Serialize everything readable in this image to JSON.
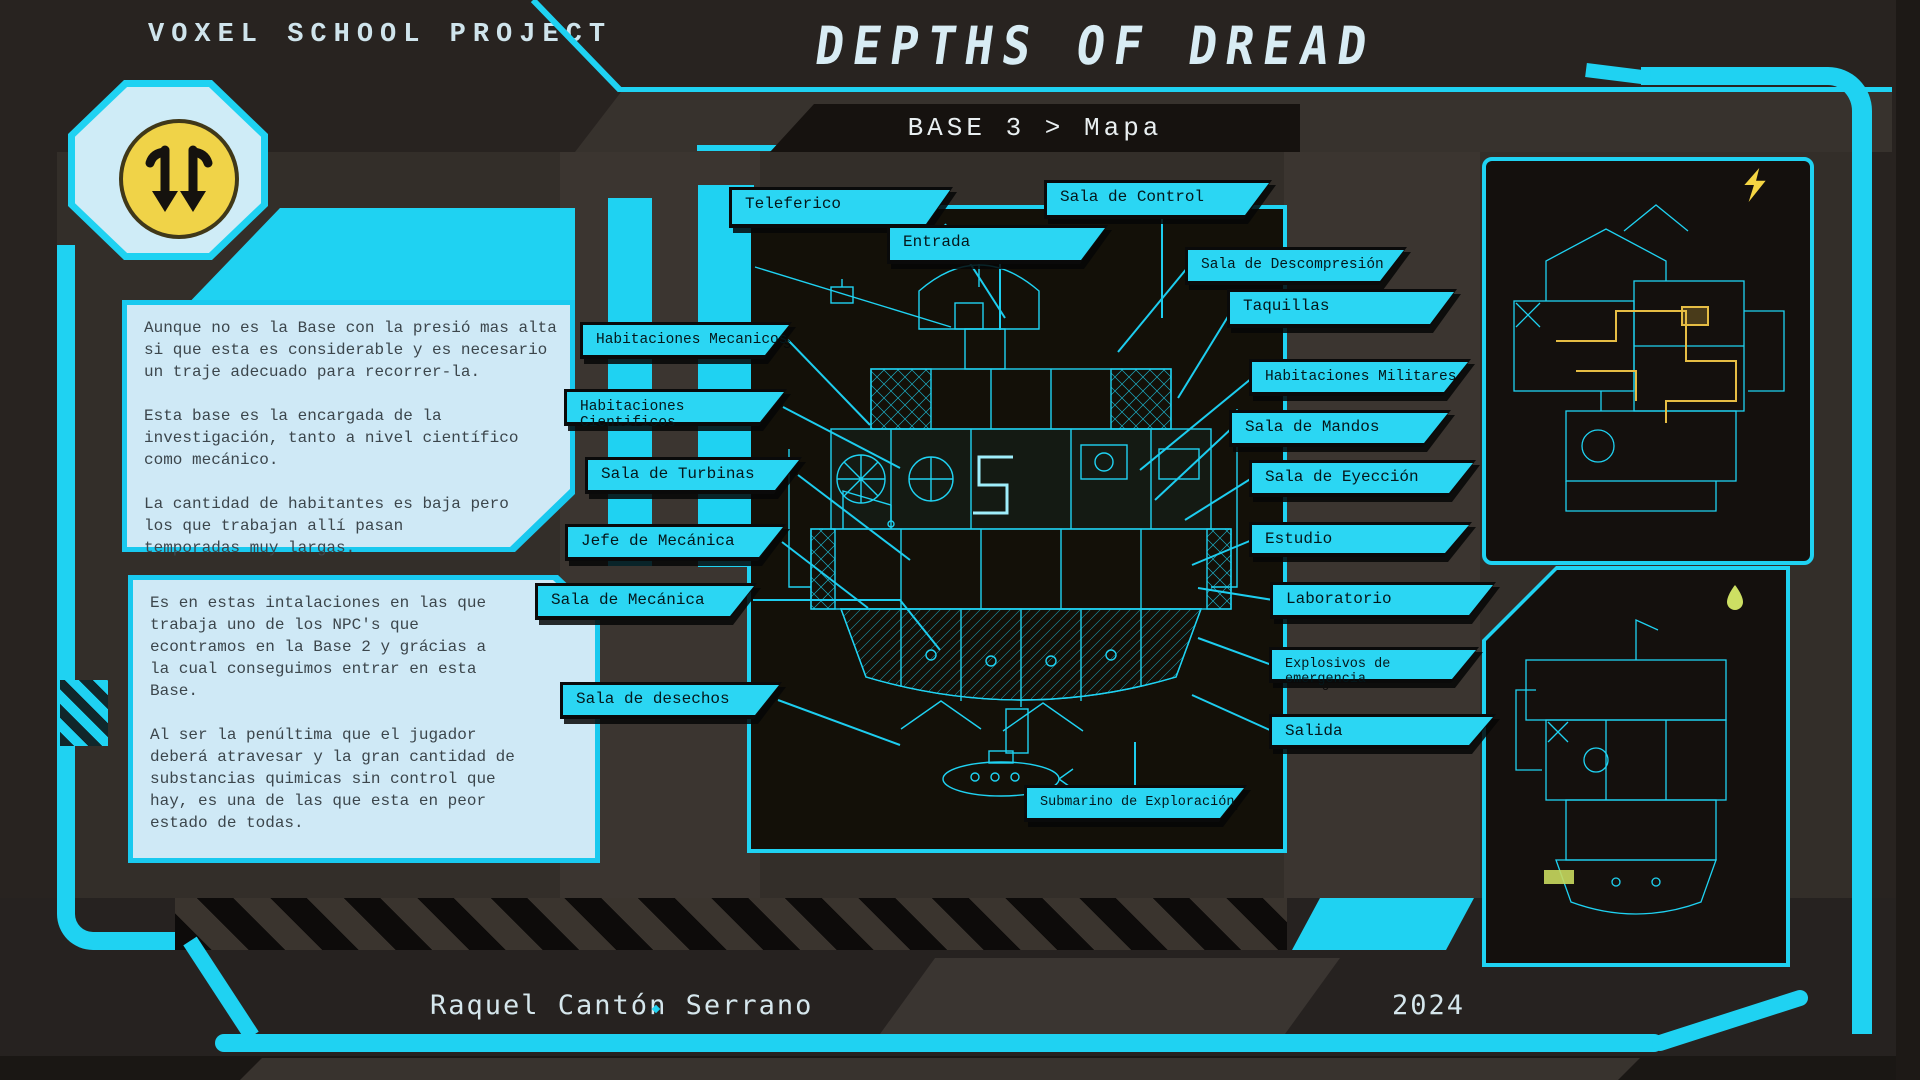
{
  "header": {
    "project_label": "VOXEL SCHOOL PROJECT",
    "title": "DEPTHS OF DREAD",
    "breadcrumb": "BASE 3 > Mapa"
  },
  "info_boxes": [
    {
      "text": "Aunque no es la Base con la presió mas alta\nsi que esta es considerable y es necesario\nun traje adecuado para recorrer-la.\n\nEsta base es la encargada de la\ninvestigación, tanto a nivel científico\ncomo mecánico.\n\nLa cantidad de habitantes es baja pero\nlos que trabajan allí pasan\ntemporadas muy largas."
    },
    {
      "text": "Es en estas intalaciones en las que\ntrabaja uno de los NPC's que\necontramos en la Base 2 y grácias a\nla cual conseguimos entrar en esta\nBase.\n\nAl ser la penúltima que el jugador\ndeberá atravesar y la gran cantidad de\nsubstancias quimicas sin control que\nhay, es una de las que esta en peor\nestado de todas."
    }
  ],
  "map_labels": [
    {
      "text": "Teleferico"
    },
    {
      "text": "Entrada"
    },
    {
      "text": "Sala de Control"
    },
    {
      "text": "Sala de Descompresión"
    },
    {
      "text": "Taquillas"
    },
    {
      "text": "Habitaciones Mecanicos"
    },
    {
      "text": "Habitaciones Cientificos"
    },
    {
      "text": "Habitaciones Militares"
    },
    {
      "text": "Sala de Mandos"
    },
    {
      "text": "Sala de Turbinas"
    },
    {
      "text": "Sala de Eyección"
    },
    {
      "text": "Jefe de Mecánica"
    },
    {
      "text": "Estudio"
    },
    {
      "text": "Sala de Mecánica"
    },
    {
      "text": "Laboratorio"
    },
    {
      "text": "Explosivos de emergencia"
    },
    {
      "text": "Sala de desechos"
    },
    {
      "text": "Salida"
    },
    {
      "text": "Submarino de Exploración"
    }
  ],
  "footer": {
    "author": "Raquel Cantón Serrano",
    "year": "2024"
  },
  "icons": {
    "logo": "double-down-arrows-icon",
    "top_panel": "lightning-icon",
    "bottom_panel": "droplet-icon"
  },
  "colors": {
    "accent": "#1fd2f2",
    "panel_light": "#cfe9f6",
    "logo_yellow": "#f0d348",
    "map_highlight": "#e6bd44"
  }
}
